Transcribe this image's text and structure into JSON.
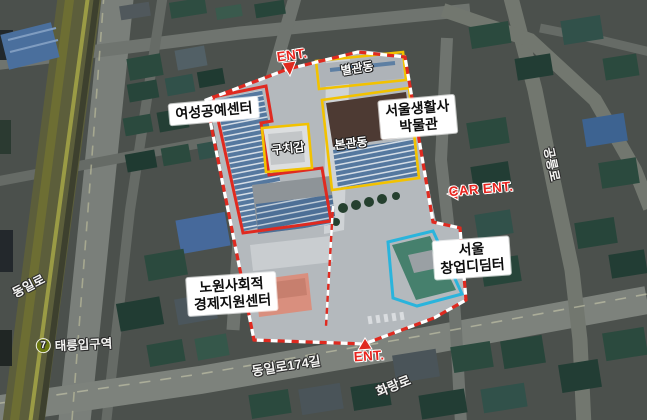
{
  "map_type": "aerial-annotated-map",
  "site_labels": {
    "craft_center": "여성공예센터",
    "museum_line1": "서울생활사",
    "museum_line2": "박물관",
    "nowon_line1": "노원사회적",
    "nowon_line2": "경제지원센터",
    "startup_line1": "서울",
    "startup_line2": "창업디딤터"
  },
  "building_labels": {
    "annex": "별관동",
    "main": "본관동",
    "guchigam": "구치감"
  },
  "road_labels": {
    "dongil": "동일로",
    "dongil174": "동일로174길",
    "hwarang": "화랑로",
    "gongneung": "공릉로"
  },
  "station": {
    "line_number": "7",
    "name": "태릉입구역"
  },
  "entrances": {
    "top": "ENT.",
    "car": "CAR ENT.",
    "bottom": "ENT."
  },
  "colors": {
    "boundary_red": "#e02a20",
    "outline_yellow": "#f2c200",
    "outline_cyan": "#2ab4dc",
    "ent_text_red": "#e8251f",
    "subway_line7_olive": "#6d7a10",
    "road_gray": "#757a74",
    "roof_green": "#2b4a3e",
    "roof_blue": "#46699b",
    "site_ground": "#b7bcc0"
  }
}
